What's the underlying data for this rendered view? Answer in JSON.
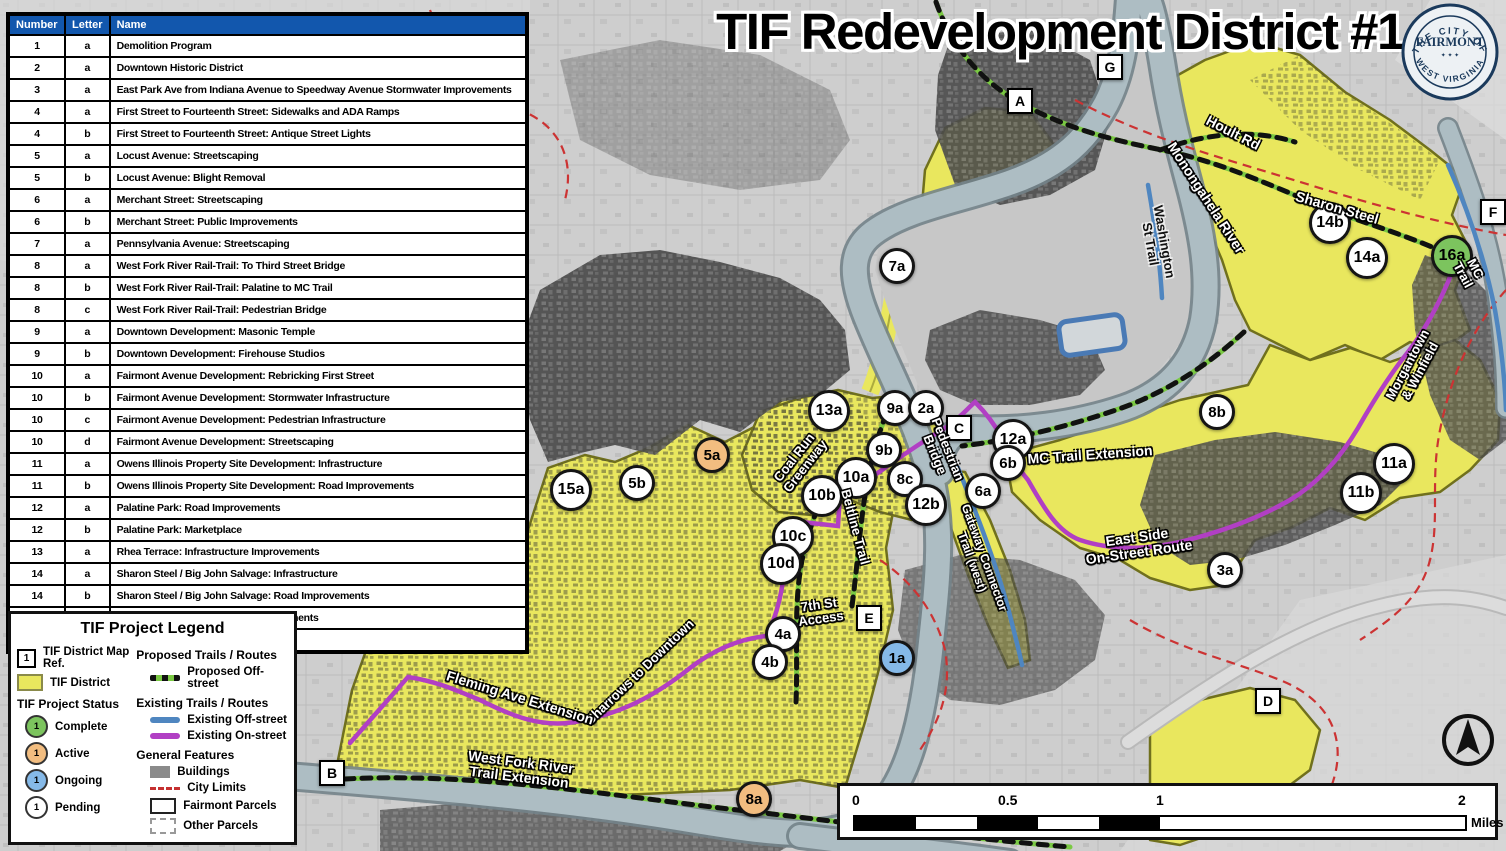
{
  "title": "TIF Redevelopment District #1",
  "seal": {
    "arc_top": "THE CITY OF",
    "name": "FAIRMONT",
    "arc_bottom": "WEST VIRGINIA"
  },
  "colors": {
    "table_header": "#1257ad",
    "district_yellow": "#e9e75e",
    "status": {
      "complete": "#7cc45e",
      "active": "#f2bd80",
      "ongoing": "#85b9e8",
      "pending": "#ffffff"
    },
    "proposed_trail": "#7ac943",
    "existing_offstreet": "#4f86c0",
    "existing_onstreet": "#b13fc4",
    "city_limits": "#c53030"
  },
  "table": {
    "headers": [
      "Number",
      "Letter",
      "Name"
    ],
    "rows": [
      [
        "1",
        "a",
        "Demolition Program"
      ],
      [
        "2",
        "a",
        "Downtown Historic District"
      ],
      [
        "3",
        "a",
        "East Park Ave from Indiana Avenue to Speedway Avenue Stormwater Improvements"
      ],
      [
        "4",
        "a",
        "First Street to Fourteenth Street: Sidewalks and ADA Ramps"
      ],
      [
        "4",
        "b",
        "First Street to Fourteenth Street: Antique Street Lights"
      ],
      [
        "5",
        "a",
        "Locust Avenue: Streetscaping"
      ],
      [
        "5",
        "b",
        "Locust Avenue: Blight Removal"
      ],
      [
        "6",
        "a",
        "Merchant Street: Streetscaping"
      ],
      [
        "6",
        "b",
        "Merchant Street: Public Improvements"
      ],
      [
        "7",
        "a",
        "Pennsylvania Avenue: Streetscaping"
      ],
      [
        "8",
        "a",
        "West Fork River Rail-Trail: To Third Street Bridge"
      ],
      [
        "8",
        "b",
        "West Fork River Rail-Trail: Palatine to MC Trail"
      ],
      [
        "8",
        "c",
        "West Fork River Rail-Trail: Pedestrian Bridge"
      ],
      [
        "9",
        "a",
        "Downtown Development: Masonic Temple"
      ],
      [
        "9",
        "b",
        "Downtown Development: Firehouse Studios"
      ],
      [
        "10",
        "a",
        "Fairmont Avenue Development: Rebricking First Street"
      ],
      [
        "10",
        "b",
        "Fairmont Avenue Development: Stormwater Infrastructure"
      ],
      [
        "10",
        "c",
        "Fairmont Avenue Development: Pedestrian Infrastructure"
      ],
      [
        "10",
        "d",
        "Fairmont Avenue Development: Streetscaping"
      ],
      [
        "11",
        "a",
        "Owens Illinois Property Site Development: Infrastructure"
      ],
      [
        "11",
        "b",
        "Owens Illinois Property Site Development: Road Improvements"
      ],
      [
        "12",
        "a",
        "Palatine Park: Road Improvements"
      ],
      [
        "12",
        "b",
        "Palatine Park: Marketplace"
      ],
      [
        "13",
        "a",
        "Rhea Terrace: Infrastructure Improvements"
      ],
      [
        "14",
        "a",
        "Sharon Steel / Big John Salvage: Infrastructure"
      ],
      [
        "14",
        "b",
        "Sharon Steel / Big John Salvage: Road Improvements"
      ],
      [
        "15",
        "a",
        "Locust Avenue: Stormwater Improvements"
      ],
      [
        "16",
        "a",
        "Norwood Park"
      ]
    ]
  },
  "legend": {
    "title": "TIF Project Legend",
    "map_ref": {
      "symbol": "1",
      "label": "TIF District Map Ref."
    },
    "district_label": "TIF District",
    "status_title": "TIF Project Status",
    "statuses": [
      {
        "key": "complete",
        "symbol": "1",
        "label": "Complete"
      },
      {
        "key": "active",
        "symbol": "1",
        "label": "Active"
      },
      {
        "key": "ongoing",
        "symbol": "1",
        "label": "Ongoing"
      },
      {
        "key": "pending",
        "symbol": "1",
        "label": "Pending"
      }
    ],
    "proposed_title": "Proposed Trails / Routes",
    "proposed_offstreet": "Proposed Off-street",
    "existing_title": "Existing Trails / Routes",
    "existing_offstreet": "Existing Off-street",
    "existing_onstreet": "Existing On-street",
    "general_title": "General Features",
    "buildings": "Buildings",
    "city_limits": "City Limits",
    "fairmont_parcels": "Fairmont Parcels",
    "other_parcels": "Other Parcels"
  },
  "map": {
    "ref_labels": [
      {
        "label": "A",
        "x": 1020,
        "y": 101
      },
      {
        "label": "B",
        "x": 332,
        "y": 773
      },
      {
        "label": "C",
        "x": 959,
        "y": 428
      },
      {
        "label": "D",
        "x": 1268,
        "y": 701
      },
      {
        "label": "E",
        "x": 869,
        "y": 618
      },
      {
        "label": "F",
        "x": 1493,
        "y": 212
      },
      {
        "label": "G",
        "x": 1110,
        "y": 67
      }
    ],
    "markers": [
      {
        "label": "7a",
        "x": 897,
        "y": 266,
        "status": "pending"
      },
      {
        "label": "14b",
        "x": 1330,
        "y": 223,
        "status": "pending"
      },
      {
        "label": "14a",
        "x": 1367,
        "y": 258,
        "status": "pending"
      },
      {
        "label": "16a",
        "x": 1452,
        "y": 256,
        "status": "complete"
      },
      {
        "label": "13a",
        "x": 829,
        "y": 411,
        "status": "pending"
      },
      {
        "label": "9a",
        "x": 895,
        "y": 408,
        "status": "pending"
      },
      {
        "label": "2a",
        "x": 926,
        "y": 408,
        "status": "pending"
      },
      {
        "label": "8b",
        "x": 1217,
        "y": 412,
        "status": "pending"
      },
      {
        "label": "12a",
        "x": 1013,
        "y": 440,
        "status": "pending"
      },
      {
        "label": "9b",
        "x": 884,
        "y": 450,
        "status": "pending"
      },
      {
        "label": "5a",
        "x": 712,
        "y": 455,
        "status": "active"
      },
      {
        "label": "6b",
        "x": 1008,
        "y": 463,
        "status": "pending"
      },
      {
        "label": "10a",
        "x": 856,
        "y": 478,
        "status": "pending"
      },
      {
        "label": "8c",
        "x": 905,
        "y": 479,
        "status": "pending"
      },
      {
        "label": "6a",
        "x": 983,
        "y": 491,
        "status": "pending"
      },
      {
        "label": "15a",
        "x": 571,
        "y": 490,
        "status": "pending"
      },
      {
        "label": "5b",
        "x": 637,
        "y": 483,
        "status": "pending"
      },
      {
        "label": "10b",
        "x": 822,
        "y": 496,
        "status": "pending"
      },
      {
        "label": "12b",
        "x": 926,
        "y": 505,
        "status": "pending"
      },
      {
        "label": "11a",
        "x": 1394,
        "y": 464,
        "status": "pending"
      },
      {
        "label": "11b",
        "x": 1361,
        "y": 493,
        "status": "pending"
      },
      {
        "label": "10c",
        "x": 793,
        "y": 537,
        "status": "pending"
      },
      {
        "label": "10d",
        "x": 781,
        "y": 564,
        "status": "pending"
      },
      {
        "label": "3a",
        "x": 1225,
        "y": 570,
        "status": "pending"
      },
      {
        "label": "4a",
        "x": 783,
        "y": 634,
        "status": "pending"
      },
      {
        "label": "4b",
        "x": 770,
        "y": 662,
        "status": "pending"
      },
      {
        "label": "1a",
        "x": 897,
        "y": 658,
        "status": "ongoing"
      },
      {
        "label": "8a",
        "x": 754,
        "y": 799,
        "status": "active"
      }
    ],
    "labels": [
      {
        "text": "Hoult Rd",
        "x": 1233,
        "y": 133,
        "rot": 27,
        "tone": "white",
        "fs": 14
      },
      {
        "text": "Monongahela River",
        "x": 1206,
        "y": 198,
        "rot": 57,
        "tone": "white",
        "fs": 14
      },
      {
        "text": "Washington\nSt Trail",
        "x": 1157,
        "y": 243,
        "rot": 80,
        "tone": "black",
        "fs": 13
      },
      {
        "text": "Sharon Steel",
        "x": 1337,
        "y": 208,
        "rot": 16,
        "tone": "white",
        "fs": 14
      },
      {
        "text": "MC Trail",
        "x": 1469,
        "y": 272,
        "rot": 62,
        "tone": "white",
        "fs": 13
      },
      {
        "text": "MC Trail Extension",
        "x": 1090,
        "y": 455,
        "rot": -4,
        "tone": "white",
        "fs": 14
      },
      {
        "text": "East Side\nOn-Street Route",
        "x": 1138,
        "y": 545,
        "rot": -8,
        "tone": "white",
        "fs": 14
      },
      {
        "text": "Morgantown\n& Winfield",
        "x": 1414,
        "y": 368,
        "rot": -62,
        "tone": "white",
        "fs": 13
      },
      {
        "text": "Coal Run\nGreenway",
        "x": 800,
        "y": 462,
        "rot": -52,
        "tone": "white",
        "fs": 13
      },
      {
        "text": "Pedestrian\nBridge",
        "x": 941,
        "y": 452,
        "rot": 68,
        "tone": "white",
        "fs": 13
      },
      {
        "text": "Beltline Trail",
        "x": 855,
        "y": 527,
        "rot": 75,
        "tone": "white",
        "fs": 13
      },
      {
        "text": "Gateway Connector\nTrail (west)",
        "x": 978,
        "y": 560,
        "rot": 70,
        "tone": "white",
        "fs": 12
      },
      {
        "text": "7th St\nAccess",
        "x": 820,
        "y": 612,
        "rot": -8,
        "tone": "white",
        "fs": 13
      },
      {
        "text": "Sharrows to Downtown",
        "x": 640,
        "y": 672,
        "rot": -44,
        "tone": "white",
        "fs": 13
      },
      {
        "text": "Fleming Ave Extension",
        "x": 520,
        "y": 698,
        "rot": 17,
        "tone": "white",
        "fs": 14
      },
      {
        "text": "West Fork River\nTrail Extension",
        "x": 520,
        "y": 770,
        "rot": 7,
        "tone": "white",
        "fs": 14
      }
    ]
  },
  "scalebar": {
    "ticks": [
      "0",
      "0.5",
      "1",
      "2"
    ],
    "unit": "Miles"
  }
}
